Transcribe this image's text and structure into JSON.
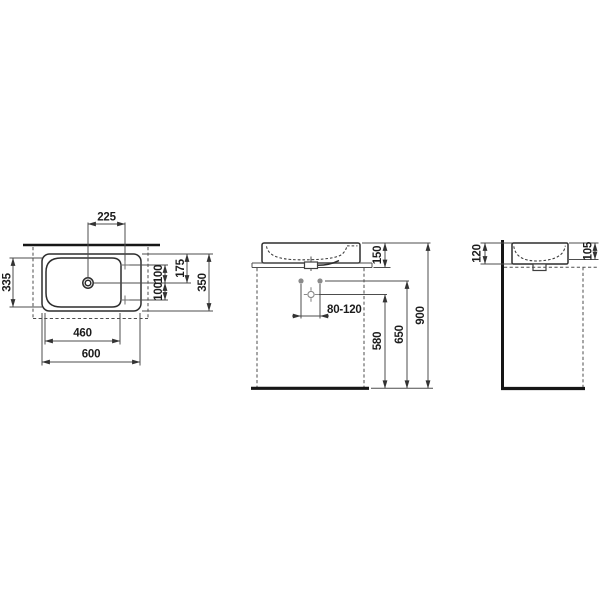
{
  "drawing": {
    "kind": "washbasin technical dimension drawing, three orthographic views",
    "colors": {
      "background": "#ffffff",
      "outline": "#2d2d2d",
      "dimension_line": "#4d4d4d",
      "thick_wall_floor": "#161616",
      "installation_gray": "#8a8a8a",
      "text": "#1c1c1c"
    },
    "symbols": {
      "drain_plan": "drain-circle",
      "tap_hole_plan": "tap-hole-cross",
      "supply_point_front": "supply-dot",
      "waste_outlet_front": "outlet-crosshair"
    },
    "views": {
      "plan": {
        "dims": {
          "drain_to_tap": "225",
          "bowl_depth": "335",
          "tap_above_axis": "100",
          "tap_below_axis": "100",
          "front_edge_to_axis": "175",
          "overall_depth": "350",
          "bowl_width": "460",
          "overall_width": "600"
        }
      },
      "front": {
        "dims": {
          "basin_height": "150",
          "supply_spacing": "80-120",
          "outlet_height": "580",
          "supply_height": "650",
          "rim_height": "900"
        }
      },
      "side": {
        "dims": {
          "rear_height": "120",
          "front_height": "105"
        }
      }
    }
  }
}
